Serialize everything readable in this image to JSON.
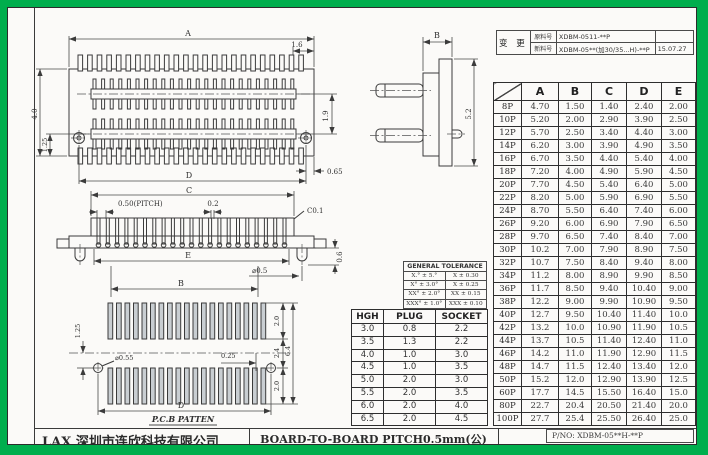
{
  "frame": {
    "green": "#00AE4D"
  },
  "title_block": {
    "company": "LAX 深圳市连欣科技有限公司",
    "drawing_title": "BOARD-TO-BOARD PITCH0.5mm(公)",
    "part_no": "P/NO: XDBM-05**H-**P"
  },
  "change_log": {
    "label": "变 更",
    "rows": [
      {
        "field": "原料号",
        "value": "XDBM-0511-**P",
        "date": ""
      },
      {
        "field": "新料号",
        "value": "XDBM-05**(加30/35...H)-**P",
        "date": "15.07.27"
      }
    ]
  },
  "dim_table": {
    "columns": [
      "A",
      "B",
      "C",
      "D",
      "E"
    ],
    "rows": [
      {
        "pins": "8P",
        "values": [
          "4.70",
          "1.50",
          "1.40",
          "2.40",
          "2.00"
        ]
      },
      {
        "pins": "10P",
        "values": [
          "5.20",
          "2.00",
          "2.90",
          "3.90",
          "2.50"
        ]
      },
      {
        "pins": "12P",
        "values": [
          "5.70",
          "2.50",
          "3.40",
          "4.40",
          "3.00"
        ]
      },
      {
        "pins": "14P",
        "values": [
          "6.20",
          "3.00",
          "3.90",
          "4.90",
          "3.50"
        ]
      },
      {
        "pins": "16P",
        "values": [
          "6.70",
          "3.50",
          "4.40",
          "5.40",
          "4.00"
        ]
      },
      {
        "pins": "18P",
        "values": [
          "7.20",
          "4.00",
          "4.90",
          "5.90",
          "4.50"
        ]
      },
      {
        "pins": "20P",
        "values": [
          "7.70",
          "4.50",
          "5.40",
          "6.40",
          "5.00"
        ]
      },
      {
        "pins": "22P",
        "values": [
          "8.20",
          "5.00",
          "5.90",
          "6.90",
          "5.50"
        ]
      },
      {
        "pins": "24P",
        "values": [
          "8.70",
          "5.50",
          "6.40",
          "7.40",
          "6.00"
        ]
      },
      {
        "pins": "26P",
        "values": [
          "9.20",
          "6.00",
          "6.90",
          "7.90",
          "6.50"
        ]
      },
      {
        "pins": "28P",
        "values": [
          "9.70",
          "6.50",
          "7.40",
          "8.40",
          "7.00"
        ]
      },
      {
        "pins": "30P",
        "values": [
          "10.2",
          "7.00",
          "7.90",
          "8.90",
          "7.50"
        ]
      },
      {
        "pins": "32P",
        "values": [
          "10.7",
          "7.50",
          "8.40",
          "9.40",
          "8.00"
        ]
      },
      {
        "pins": "34P",
        "values": [
          "11.2",
          "8.00",
          "8.90",
          "9.90",
          "8.50"
        ]
      },
      {
        "pins": "36P",
        "values": [
          "11.7",
          "8.50",
          "9.40",
          "10.40",
          "9.00"
        ]
      },
      {
        "pins": "38P",
        "values": [
          "12.2",
          "9.00",
          "9.90",
          "10.90",
          "9.50"
        ]
      },
      {
        "pins": "40P",
        "values": [
          "12.7",
          "9.50",
          "10.40",
          "11.40",
          "10.0"
        ]
      },
      {
        "pins": "42P",
        "values": [
          "13.2",
          "10.0",
          "10.90",
          "11.90",
          "10.5"
        ]
      },
      {
        "pins": "44P",
        "values": [
          "13.7",
          "10.5",
          "11.40",
          "12.40",
          "11.0"
        ]
      },
      {
        "pins": "46P",
        "values": [
          "14.2",
          "11.0",
          "11.90",
          "12.90",
          "11.5"
        ]
      },
      {
        "pins": "48P",
        "values": [
          "14.7",
          "11.5",
          "12.40",
          "13.40",
          "12.0"
        ]
      },
      {
        "pins": "50P",
        "values": [
          "15.2",
          "12.0",
          "12.90",
          "13.90",
          "12.5"
        ]
      },
      {
        "pins": "60P",
        "values": [
          "17.7",
          "14.5",
          "15.50",
          "16.40",
          "15.0"
        ]
      },
      {
        "pins": "80P",
        "values": [
          "22.7",
          "20.4",
          "20.50",
          "21.40",
          "20.0"
        ]
      },
      {
        "pins": "100P",
        "values": [
          "27.7",
          "25.4",
          "25.50",
          "26.40",
          "25.0"
        ]
      }
    ]
  },
  "tolerance_table": {
    "title": "GENERAL TOLERANCE",
    "rows": [
      [
        "X.° ± 5.°",
        "X ± 0.30"
      ],
      [
        "X° ± 3.0°",
        "X ± 0.25"
      ],
      [
        "XX° ± 2.0°",
        "XX ± 0.15"
      ],
      [
        "XXX° ± 1.0°",
        "XXX ± 0.10"
      ]
    ]
  },
  "hgh_table": {
    "columns": [
      "HGH",
      "PLUG",
      "SOCKET"
    ],
    "rows": [
      [
        "3.0",
        "0.8",
        "2.2"
      ],
      [
        "3.5",
        "1.3",
        "2.2"
      ],
      [
        "4.0",
        "1.0",
        "3.0"
      ],
      [
        "4.5",
        "1.0",
        "3.5"
      ],
      [
        "5.0",
        "2.0",
        "3.0"
      ],
      [
        "5.5",
        "2.0",
        "3.5"
      ],
      [
        "6.0",
        "2.0",
        "4.0"
      ],
      [
        "6.5",
        "2.0",
        "4.5"
      ]
    ]
  },
  "drawings": {
    "top_view": {
      "dim_a": "A",
      "dim_1_6": "1.6",
      "dim_1_9": "1.9",
      "dim_4_0": "4.0",
      "dim_1_25": "1.25",
      "dim_d": "D",
      "dim_0_65": "0.65"
    },
    "side_view": {
      "dim_b": "B",
      "dim_5_2": "5.2"
    },
    "front_view": {
      "dim_c": "C",
      "pitch": "0.50(PITCH)",
      "dim_0_2": "0.2",
      "chamfer": "C0.1",
      "dim_e": "E",
      "dim_b": "B",
      "dim_dia_0_5": "⌀0.5",
      "dim_0_6": "0.6"
    },
    "pcb_view": {
      "dim_1_25": "1.25",
      "dim_2_0_top": "2.0",
      "dim_2_4": "2.4",
      "dim_2_0_bot": "2.0",
      "dim_6_4": "6.4",
      "dim_0_25": "0.25",
      "dim_dia_0_55": "⌀0.55",
      "dim_d": "D",
      "caption": "P.C.B PATTEN"
    }
  }
}
